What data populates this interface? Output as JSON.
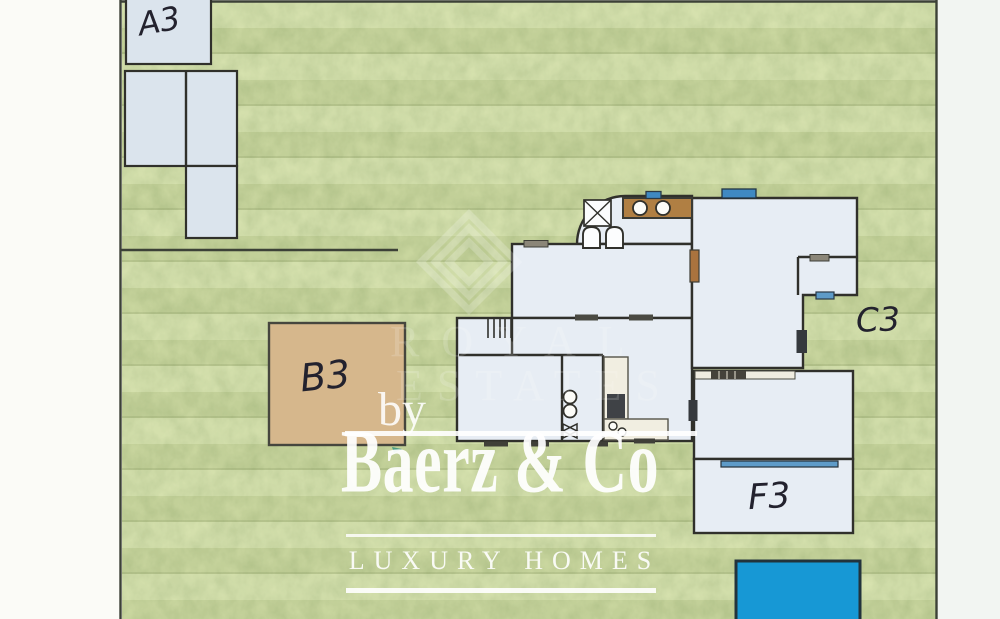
{
  "plan": {
    "unit_labels": {
      "a": "A3",
      "b": "B3",
      "c": "C3",
      "f": "F3"
    }
  },
  "watermark": {
    "by": "by",
    "brand": "Baerz & Co",
    "tagline": "LUXURY HOMES",
    "ghost_word_1": "ROYAL",
    "ghost_word_2": "ESTATES"
  },
  "colors": {
    "paper": "#fbfbf7",
    "paper_right": "#f2f5f2",
    "grass": "#a9bd79",
    "boundary_line": "#3c4137",
    "wall": "#30302b",
    "building_fill": "#e7edf4",
    "outbuilding_fill": "#dbe4ed",
    "terrace_tan": "#d6b78c",
    "counter_brown": "#b07f43",
    "pool_blue": "#1798d5",
    "window_blue": "#3f89c2",
    "window_blue_light": "#5e9bc8",
    "watermark_white": "#ffffff",
    "ink": "#23222e"
  }
}
